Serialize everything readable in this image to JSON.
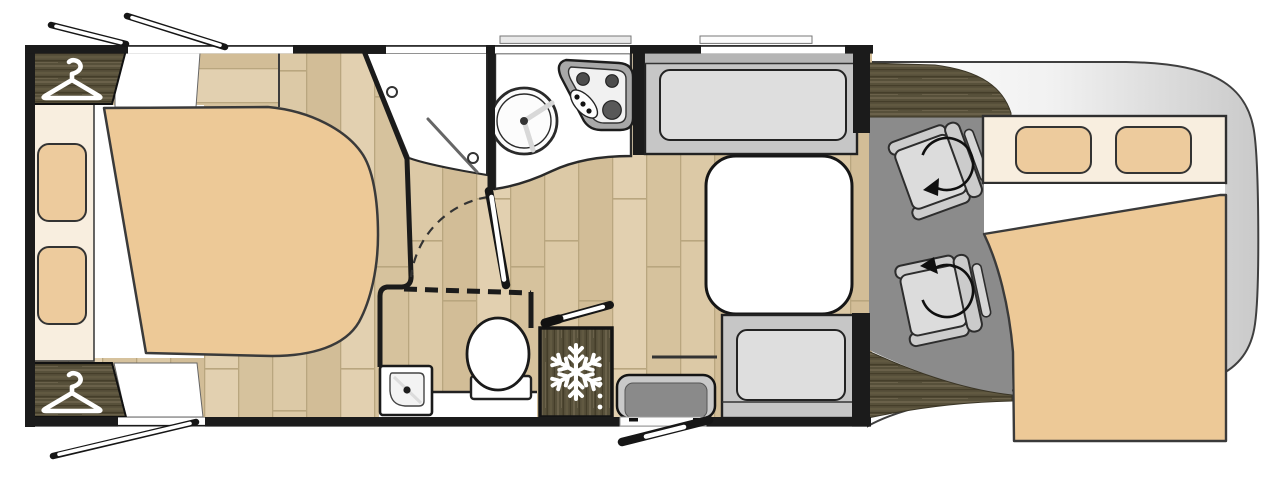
{
  "app": {
    "name": "Motorhome floor plan",
    "type": "top-down vehicle layout diagram"
  },
  "colors": {
    "wall": "#1b1b1b",
    "outline": "#2d2d2d",
    "floorA": "#dcc9a6",
    "floorB": "#d2bd97",
    "floorC": "#e2d0b0",
    "floorD": "#d6c29d",
    "floorLine": "#b9a67f",
    "wood": "#57503a",
    "woodHi": "#6a614a",
    "woodLo": "#453e2a",
    "mattress": "#edc997",
    "pillow": "#edcb9d",
    "headboard": "#f8eedf",
    "bench": "#c6c6c6",
    "cushion": "#dedede",
    "benchDark": "#b5b5b5",
    "cabFloor": "#8b8b8b",
    "seat": "#dcdcdc",
    "seatTrim": "#cccccc",
    "sideSeat": "#8a8a8a",
    "noseA": "#fdfdfd",
    "noseB": "#c9c9c9",
    "hob": "#a8a8a8",
    "burner": "#4c4c4c",
    "iconWhite": "#ffffff"
  },
  "features": {
    "vehicle": "Motorhome floor plan",
    "rear_bed": "Rear island bed",
    "headboard": "Headboard shelf",
    "pillow": "Pillow",
    "wardrobe": "Wardrobe with clothes hanger",
    "shelf": "Bedside shelf",
    "shower": "Corner shower with glass door",
    "toilet": "Toilet",
    "washbasin": "Corner washbasin",
    "vanity": "Vanity shelf",
    "sliding_door": "Sliding partition (dashed)",
    "bath_door": "Washroom door with swing arc",
    "kitchen": "Kitchen worktop",
    "sink": "Round kitchen sink",
    "hob": "Three-burner gas hob",
    "fridge": "Refrigerator cabinet",
    "bench_front": "Front dinette bench",
    "bench_rear": "Rear dinette bench",
    "side_seat": "Entry side seat",
    "table": "Dinette table",
    "entry_door": "Entry door shown open",
    "threshold": "Entry step",
    "window": "Opening window",
    "cab": "Driver cab floor",
    "driver_seat": "Swivelling driver seat",
    "passenger_seat": "Swivelling passenger seat",
    "swivel_arrow": "Seat swivel arrow",
    "drop_bed": "Drop-down bed over cab",
    "cab_nose": "Cab front outline",
    "wood_trim": "Dark wood trim panel",
    "hanger_icon": "Clothes hanger icon",
    "snowflake_icon": "Snowflake fridge icon"
  }
}
